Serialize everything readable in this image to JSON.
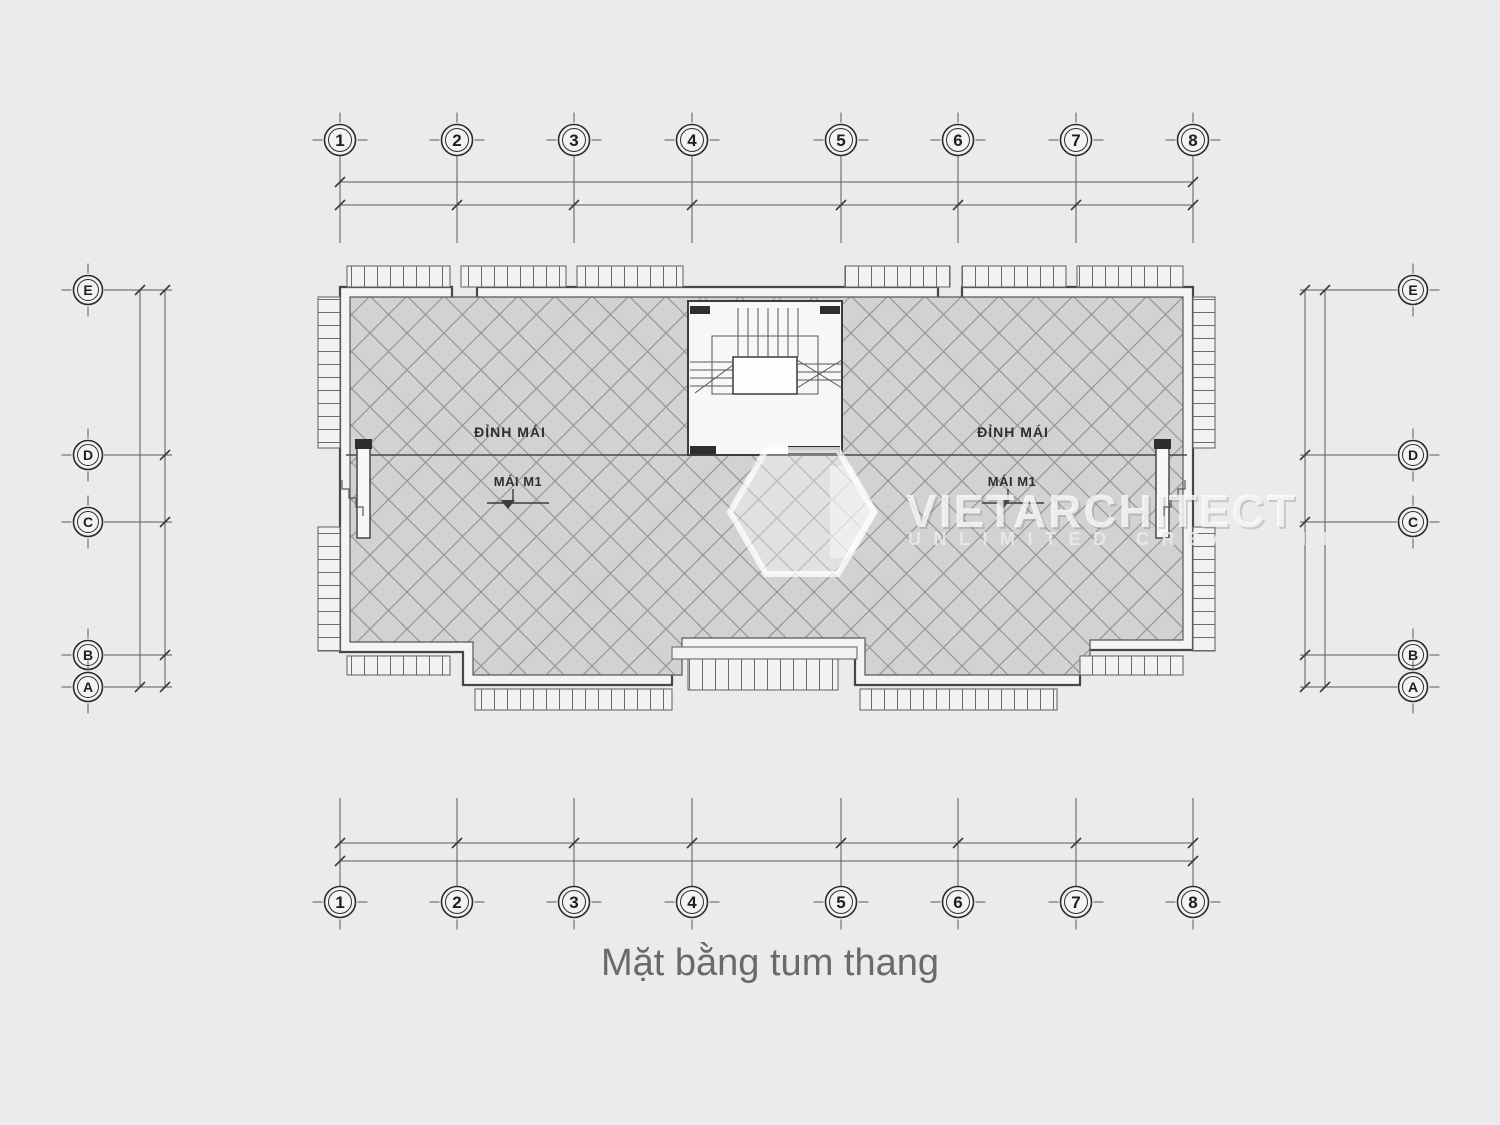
{
  "title": {
    "text": "Mặt bằng tum thang",
    "color": "#6a6a6a"
  },
  "grid": {
    "columns": [
      "1",
      "2",
      "3",
      "4",
      "5",
      "6",
      "7",
      "8"
    ],
    "rows": [
      "E",
      "D",
      "C",
      "B",
      "A"
    ]
  },
  "plan": {
    "roof_labels": {
      "left_ridge": "ĐỈNH MÁI",
      "right_ridge": "ĐỈNH MÁI",
      "left_roof": "MÁI M1",
      "right_roof": "MÁI M1"
    },
    "colors": {
      "page_background": "#ebebec",
      "roof_fill": "#d2d2d4",
      "hatch_line": "#96969a",
      "outline_dark": "#47474a",
      "grid_line": "#55555a",
      "band_fill": "#f4f4f5"
    }
  },
  "watermark": {
    "brand": "VIETARCHITECT",
    "tagline": "UNLIMITED CREATIVITY"
  }
}
